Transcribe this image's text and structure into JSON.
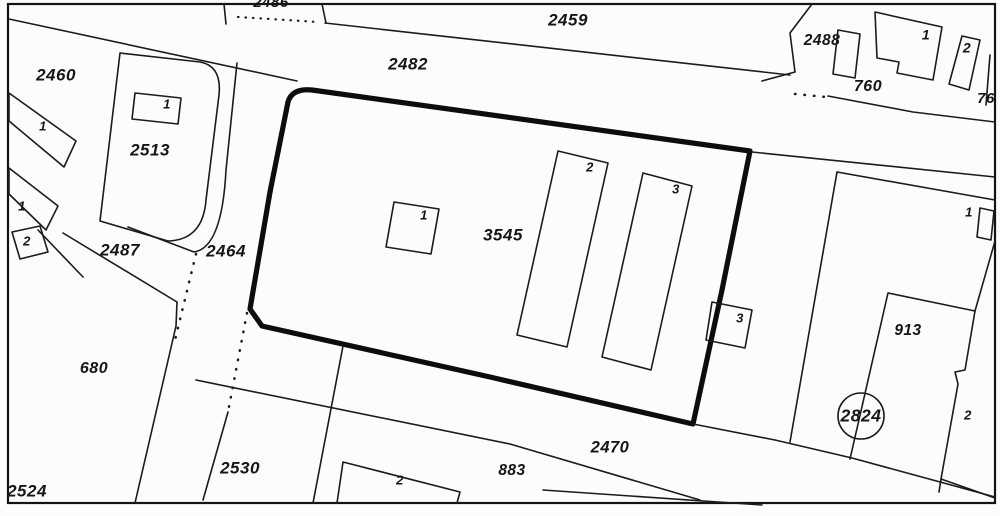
{
  "map": {
    "title": "cadastral-parcel-map",
    "colors": {
      "background": "#fcfcfc",
      "ink": "#1b1b1b",
      "bold_outline": "#0d0d0d"
    },
    "frame": {
      "x": 8,
      "y": 4,
      "width": 987,
      "height": 499
    },
    "shapes": [
      {
        "name": "road-edge-upper-left",
        "style": "thin",
        "type": "polyline",
        "points": [
          [
            9,
            19
          ],
          [
            297,
            81
          ]
        ]
      },
      {
        "name": "parcel-2459-south-boundary",
        "style": "thin",
        "type": "polyline",
        "points": [
          [
            325,
            23
          ],
          [
            790,
            75
          ]
        ]
      },
      {
        "name": "parcel-2486-left-tick",
        "style": "thin",
        "type": "polyline",
        "points": [
          [
            224,
            4
          ],
          [
            226,
            24
          ]
        ]
      },
      {
        "name": "parcel-2486-right-tick",
        "style": "thin",
        "type": "polyline",
        "points": [
          [
            322,
            4
          ],
          [
            326,
            23
          ]
        ]
      },
      {
        "name": "parcel-2486-dotted-boundary",
        "style": "dotted-fine",
        "type": "polyline",
        "points": [
          [
            238,
            17
          ],
          [
            318,
            22
          ]
        ]
      },
      {
        "name": "parcel-3545-bold-boundary",
        "style": "bold",
        "type": "path",
        "d": "M262,326 L250,309 L270,192 L288,102 Q292,88 312,90 L750,151 L722,290 L693,424 L490,377 Z"
      },
      {
        "name": "building-1-parcel-3545",
        "style": "thin",
        "type": "polygon",
        "points": [
          [
            394,
            202
          ],
          [
            439,
            209
          ],
          [
            431,
            254
          ],
          [
            386,
            247
          ]
        ]
      },
      {
        "name": "building-2-parcel-3545",
        "style": "thin",
        "type": "polygon",
        "points": [
          [
            558,
            151
          ],
          [
            608,
            163
          ],
          [
            567,
            347
          ],
          [
            517,
            335
          ]
        ]
      },
      {
        "name": "building-3-parcel-3545",
        "style": "thin",
        "type": "polygon",
        "points": [
          [
            643,
            173
          ],
          [
            692,
            186
          ],
          [
            651,
            370
          ],
          [
            602,
            357
          ]
        ]
      },
      {
        "name": "building-3-annex",
        "style": "thin",
        "type": "polygon",
        "points": [
          [
            712,
            302
          ],
          [
            752,
            310
          ],
          [
            745,
            348
          ],
          [
            706,
            340
          ]
        ]
      },
      {
        "name": "parcel-2513-boundary",
        "style": "thin",
        "type": "path",
        "d": "M120,53 L200,62 Q222,66 219,95 L206,200 Q203,240 168,241 L100,221 Z"
      },
      {
        "name": "parcel-2513-outer-boundary",
        "style": "thin",
        "type": "path",
        "d": "M237,63 L226,170 Q222,248 194,252 L128,227"
      },
      {
        "name": "building-1-parcel-2513",
        "style": "thin",
        "type": "polygon",
        "points": [
          [
            135,
            93
          ],
          [
            181,
            98
          ],
          [
            178,
            124
          ],
          [
            132,
            119
          ]
        ]
      },
      {
        "name": "strip-building-upper-left",
        "style": "thin",
        "type": "polygon",
        "points": [
          [
            9,
            93
          ],
          [
            76,
            141
          ],
          [
            64,
            167
          ],
          [
            9,
            121
          ]
        ]
      },
      {
        "name": "strip-building-lower-left",
        "style": "thin",
        "type": "polygon",
        "points": [
          [
            9,
            168
          ],
          [
            58,
            206
          ],
          [
            46,
            230
          ],
          [
            9,
            194
          ]
        ]
      },
      {
        "name": "small-building-2-left",
        "style": "thin",
        "type": "polygon",
        "points": [
          [
            12,
            232
          ],
          [
            40,
            226
          ],
          [
            48,
            252
          ],
          [
            20,
            259
          ]
        ]
      },
      {
        "name": "boundary-left-cross",
        "style": "thin",
        "type": "polyline",
        "points": [
          [
            38,
            230
          ],
          [
            83,
            277
          ]
        ]
      },
      {
        "name": "parcel-680-north-boundary",
        "style": "thin",
        "type": "polyline",
        "points": [
          [
            63,
            233
          ],
          [
            177,
            302
          ]
        ]
      },
      {
        "name": "parcel-680-east-boundary",
        "style": "thin",
        "type": "polyline",
        "points": [
          [
            177,
            302
          ],
          [
            176,
            326
          ],
          [
            135,
            503
          ]
        ]
      },
      {
        "name": "road-2464-dotted-west",
        "style": "dotted",
        "type": "polyline",
        "points": [
          [
            196,
            254
          ],
          [
            175,
            340
          ]
        ]
      },
      {
        "name": "road-2464-dotted-east",
        "style": "dotted",
        "type": "polyline",
        "points": [
          [
            247,
            313
          ],
          [
            228,
            412
          ]
        ]
      },
      {
        "name": "road-2464-lower-boundary",
        "style": "thin",
        "type": "polyline",
        "points": [
          [
            228,
            412
          ],
          [
            203,
            500
          ]
        ]
      },
      {
        "name": "parcel-2530-east-boundary",
        "style": "thin",
        "type": "polyline",
        "points": [
          [
            343,
            346
          ],
          [
            313,
            503
          ]
        ]
      },
      {
        "name": "road-2470-south-boundary",
        "style": "thin",
        "type": "polyline",
        "points": [
          [
            196,
            380
          ],
          [
            510,
            444
          ],
          [
            700,
            500
          ]
        ]
      },
      {
        "name": "parcel-883-south-boundary",
        "style": "thin",
        "type": "polyline",
        "points": [
          [
            543,
            490
          ],
          [
            762,
            505
          ]
        ]
      },
      {
        "name": "road-2470-north-boundary",
        "style": "thin",
        "type": "polyline",
        "points": [
          [
            693,
            424
          ],
          [
            775,
            440
          ],
          [
            852,
            458
          ],
          [
            995,
            497
          ]
        ]
      },
      {
        "name": "building-2-bottom-right-south",
        "style": "thin",
        "type": "polyline",
        "points": [
          [
            941,
            479
          ],
          [
            995,
            498
          ]
        ]
      },
      {
        "name": "block-2488-west-boundary",
        "style": "thin",
        "type": "polyline",
        "points": [
          [
            812,
            4
          ],
          [
            790,
            33
          ],
          [
            795,
            72
          ],
          [
            762,
            81
          ]
        ]
      },
      {
        "name": "block-760-dotted-boundary",
        "style": "dotted",
        "type": "polyline",
        "points": [
          [
            795,
            94
          ],
          [
            826,
            97
          ]
        ]
      },
      {
        "name": "block-760-south-boundary",
        "style": "thin",
        "type": "polyline",
        "points": [
          [
            828,
            96
          ],
          [
            913,
            112
          ],
          [
            995,
            122
          ]
        ]
      },
      {
        "name": "road-north-of-913",
        "style": "thin",
        "type": "polyline",
        "points": [
          [
            752,
            152
          ],
          [
            995,
            177
          ]
        ]
      },
      {
        "name": "parcel-913-north-boundary",
        "style": "thin",
        "type": "polyline",
        "points": [
          [
            837,
            172
          ],
          [
            995,
            200
          ]
        ]
      },
      {
        "name": "parcel-913-west-boundary",
        "style": "thin",
        "type": "polyline",
        "points": [
          [
            837,
            172
          ],
          [
            790,
            442
          ]
        ]
      },
      {
        "name": "building-913-outline",
        "style": "thin",
        "type": "polyline",
        "points": [
          [
            995,
            241
          ],
          [
            975,
            311
          ],
          [
            888,
            293
          ],
          [
            850,
            459
          ]
        ]
      },
      {
        "name": "building-913-east-outline",
        "style": "thin",
        "type": "polyline",
        "points": [
          [
            975,
            311
          ],
          [
            965,
            370
          ],
          [
            955,
            372
          ],
          [
            958,
            384
          ],
          [
            941,
            479
          ],
          [
            939,
            492
          ]
        ]
      },
      {
        "name": "building-1-right-edge",
        "style": "thin",
        "type": "polygon",
        "points": [
          [
            980,
            208
          ],
          [
            994,
            211
          ],
          [
            991,
            240
          ],
          [
            977,
            237
          ]
        ]
      },
      {
        "name": "survey-circle-2824",
        "style": "thin",
        "type": "circle",
        "cx": 861,
        "cy": 416,
        "r": 23
      },
      {
        "name": "building-2488-annex",
        "style": "thin",
        "type": "polygon",
        "points": [
          [
            838,
            30
          ],
          [
            860,
            34
          ],
          [
            855,
            78
          ],
          [
            833,
            74
          ]
        ]
      },
      {
        "name": "building-1-top-right",
        "style": "thin",
        "type": "path",
        "d": "M875,12 L942,27 L933,80 L897,73 L899,62 L877,58 Z"
      },
      {
        "name": "building-2-top-right",
        "style": "thin",
        "type": "polygon",
        "points": [
          [
            962,
            36
          ],
          [
            980,
            40
          ],
          [
            969,
            90
          ],
          [
            949,
            84
          ]
        ]
      },
      {
        "name": "boundary-tick-76",
        "style": "thin",
        "type": "polyline",
        "points": [
          [
            990,
            55
          ],
          [
            986,
            105
          ]
        ]
      },
      {
        "name": "building-2-bottom-center",
        "style": "thin",
        "type": "polyline",
        "points": [
          [
            337,
            503
          ],
          [
            343,
            462
          ],
          [
            460,
            492
          ],
          [
            457,
            503
          ]
        ]
      }
    ],
    "labels": [
      {
        "name": "label-2486-partial",
        "text": "2486",
        "x": 271,
        "y": 3,
        "fs": 15
      },
      {
        "name": "label-2459",
        "text": "2459",
        "x": 568,
        "y": 21,
        "fs": 17
      },
      {
        "name": "label-2482",
        "text": "2482",
        "x": 408,
        "y": 65,
        "fs": 17
      },
      {
        "name": "label-2460",
        "text": "2460",
        "x": 56,
        "y": 76,
        "fs": 17
      },
      {
        "name": "label-2513",
        "text": "2513",
        "x": 150,
        "y": 151,
        "fs": 17
      },
      {
        "name": "label-2488",
        "text": "2488",
        "x": 822,
        "y": 41,
        "fs": 15.5
      },
      {
        "name": "label-building-1-top-right",
        "text": "1",
        "x": 926,
        "y": 36,
        "fs": 14
      },
      {
        "name": "label-building-2-top-right",
        "text": "2",
        "x": 967,
        "y": 49,
        "fs": 14
      },
      {
        "name": "label-760",
        "text": "760",
        "x": 868,
        "y": 87,
        "fs": 16
      },
      {
        "name": "label-76-partial",
        "text": "76",
        "x": 986,
        "y": 99,
        "fs": 15
      },
      {
        "name": "label-building-1-2513",
        "text": "1",
        "x": 167,
        "y": 105,
        "fs": 13
      },
      {
        "name": "label-strip-1-upper",
        "text": "1",
        "x": 43,
        "y": 127,
        "fs": 13
      },
      {
        "name": "label-strip-1-lower",
        "text": "1",
        "x": 22,
        "y": 207,
        "fs": 13
      },
      {
        "name": "label-small-2-left",
        "text": "2",
        "x": 27,
        "y": 242,
        "fs": 13
      },
      {
        "name": "label-2487",
        "text": "2487",
        "x": 120,
        "y": 251,
        "fs": 17
      },
      {
        "name": "label-2464",
        "text": "2464",
        "x": 226,
        "y": 252,
        "fs": 17
      },
      {
        "name": "label-building-1-3545",
        "text": "1",
        "x": 424,
        "y": 216,
        "fs": 13
      },
      {
        "name": "label-3545",
        "text": "3545",
        "x": 503,
        "y": 236,
        "fs": 17
      },
      {
        "name": "label-building-2-3545",
        "text": "2",
        "x": 590,
        "y": 168,
        "fs": 13
      },
      {
        "name": "label-building-3-3545",
        "text": "3",
        "x": 676,
        "y": 190,
        "fs": 13
      },
      {
        "name": "label-building-3-annex",
        "text": "3",
        "x": 740,
        "y": 319,
        "fs": 13
      },
      {
        "name": "label-building-1-right",
        "text": "1",
        "x": 969,
        "y": 213,
        "fs": 13
      },
      {
        "name": "label-913",
        "text": "913",
        "x": 908,
        "y": 331,
        "fs": 15.5
      },
      {
        "name": "label-680",
        "text": "680",
        "x": 94,
        "y": 369,
        "fs": 16
      },
      {
        "name": "label-2824",
        "text": "2824",
        "x": 861,
        "y": 417,
        "fs": 17.5
      },
      {
        "name": "label-building-2-bottom-right",
        "text": "2",
        "x": 968,
        "y": 416,
        "fs": 13
      },
      {
        "name": "label-2530",
        "text": "2530",
        "x": 240,
        "y": 469,
        "fs": 17
      },
      {
        "name": "label-2470",
        "text": "2470",
        "x": 610,
        "y": 448,
        "fs": 16.5
      },
      {
        "name": "label-883",
        "text": "883",
        "x": 512,
        "y": 471,
        "fs": 15.5
      },
      {
        "name": "label-2524",
        "text": "2524",
        "x": 27,
        "y": 492,
        "fs": 17
      },
      {
        "name": "label-building-2-bottom-center",
        "text": "2",
        "x": 400,
        "y": 481,
        "fs": 13
      }
    ]
  }
}
